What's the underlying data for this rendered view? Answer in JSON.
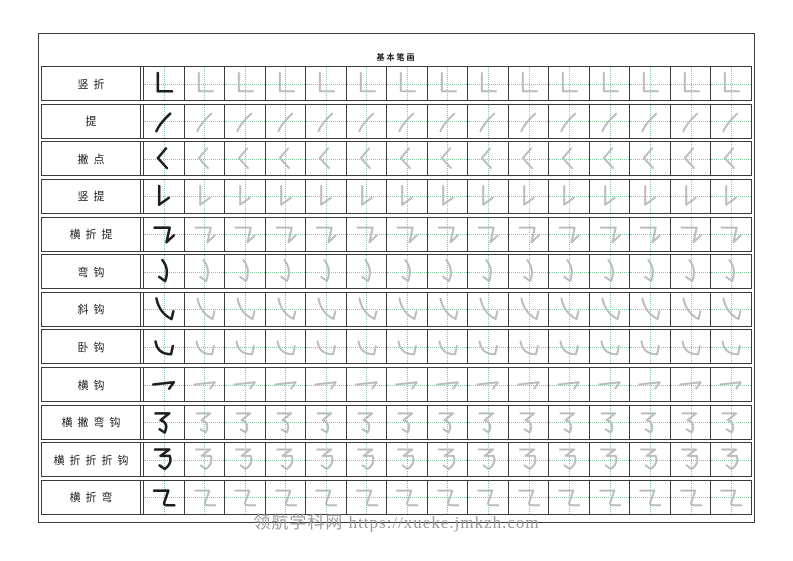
{
  "page": {
    "title": "基本笔画",
    "watermark": "领航学科网 https://xueke.jmkzh.com"
  },
  "colors": {
    "border": "#3b3b3b",
    "guide_green": "#84c9a1",
    "stroke_dark": "#1e1e1e",
    "stroke_trace": "#bcbcbc",
    "watermark_gray": "#9a9a9a",
    "background": "#ffffff"
  },
  "grid": {
    "cells_per_row": 15,
    "example_cells_per_row": 1,
    "trace_cells_per_row": 14
  },
  "rows": [
    {
      "label": "竖折",
      "stroke_name": "shu-zhe",
      "stroke_unicode": "㇗"
    },
    {
      "label": "提",
      "stroke_name": "ti",
      "stroke_unicode": "㇀"
    },
    {
      "label": "撇点",
      "stroke_name": "pie-dian",
      "stroke_unicode": "㇛"
    },
    {
      "label": "竖提",
      "stroke_name": "shu-ti",
      "stroke_unicode": "㇙"
    },
    {
      "label": "横折提",
      "stroke_name": "heng-zhe-ti",
      "stroke_unicode": "㇊"
    },
    {
      "label": "弯钩",
      "stroke_name": "wan-gou",
      "stroke_unicode": "㇁"
    },
    {
      "label": "斜钩",
      "stroke_name": "xie-gou",
      "stroke_unicode": "㇂"
    },
    {
      "label": "卧钩",
      "stroke_name": "wo-gou",
      "stroke_unicode": "㇃"
    },
    {
      "label": "横钩",
      "stroke_name": "heng-gou",
      "stroke_unicode": "㇖"
    },
    {
      "label": "横撇弯钩",
      "stroke_name": "heng-pie-wan-gou",
      "stroke_unicode": "㇌"
    },
    {
      "label": "横折折折钩",
      "stroke_name": "heng-zhe-zhe-zhe-gou",
      "stroke_unicode": "㇡"
    },
    {
      "label": "横折弯",
      "stroke_name": "heng-zhe-wan",
      "stroke_unicode": "㇍"
    }
  ]
}
